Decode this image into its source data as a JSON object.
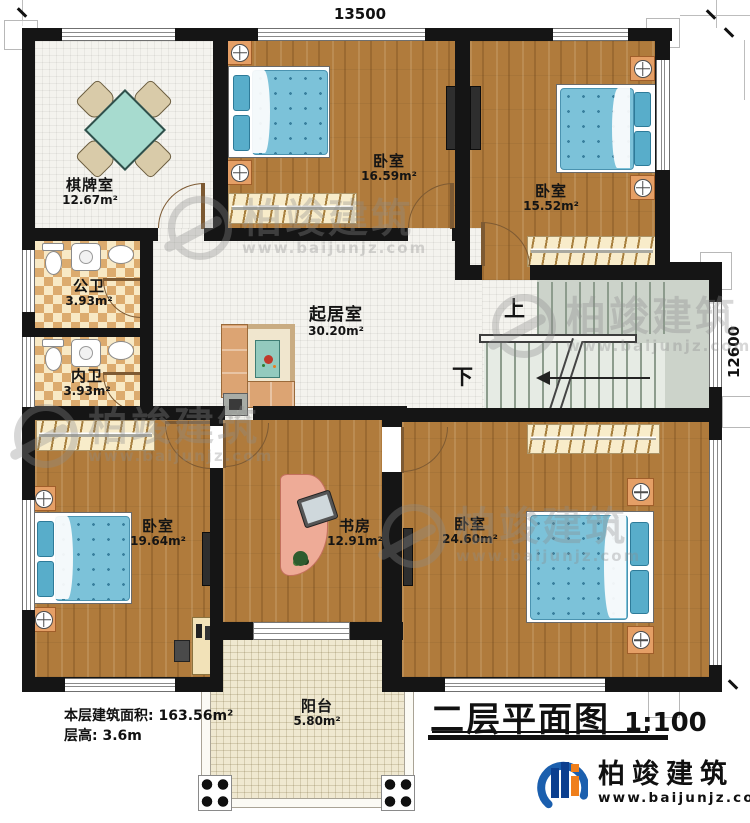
{
  "title": {
    "label": "二层平面图",
    "scale": "1:100"
  },
  "dimensions": {
    "top": "13500",
    "right": "12600"
  },
  "rooms": [
    {
      "id": "chess-room",
      "name": "棋牌室",
      "area": "12.67m²"
    },
    {
      "id": "bedroom-north",
      "name": "卧室",
      "area": "16.59m²"
    },
    {
      "id": "bedroom-northeast",
      "name": "卧室",
      "area": "15.52m²"
    },
    {
      "id": "public-bathroom",
      "name": "公卫",
      "area": "3.93m²"
    },
    {
      "id": "inner-bathroom",
      "name": "内卫",
      "area": "3.93m²"
    },
    {
      "id": "living-room",
      "name": "起居室",
      "area": "30.20m²"
    },
    {
      "id": "bedroom-southwest",
      "name": "卧室",
      "area": "19.64m²"
    },
    {
      "id": "study",
      "name": "书房",
      "area": "12.91m²"
    },
    {
      "id": "bedroom-southeast",
      "name": "卧室",
      "area": "24.60m²"
    },
    {
      "id": "balcony",
      "name": "阳台",
      "area": "5.80m²"
    }
  ],
  "stairs": {
    "up": "上",
    "down": "下"
  },
  "notes": {
    "line1": "本层建筑面积: 163.56m²",
    "line2": "层高: 3.6m"
  },
  "brand": {
    "name": "柏竣建筑",
    "url": "www.baijunjz.com"
  },
  "watermark": {
    "name": "柏竣建筑",
    "url": "www.baijunjz.com"
  },
  "colors": {
    "wall": "#151515",
    "wood_floor": "#b07b3c",
    "tile_floor": "#f4f3ee",
    "bath_checker": "#dcab6e",
    "balcony_floor": "#efe8d0",
    "stair": "#ccd3ca",
    "bed_blue": "#7cc2d9",
    "nightstand_orange": "#e59f66",
    "brand_blue": "#1b5fae",
    "brand_orange": "#ef7f1c"
  }
}
